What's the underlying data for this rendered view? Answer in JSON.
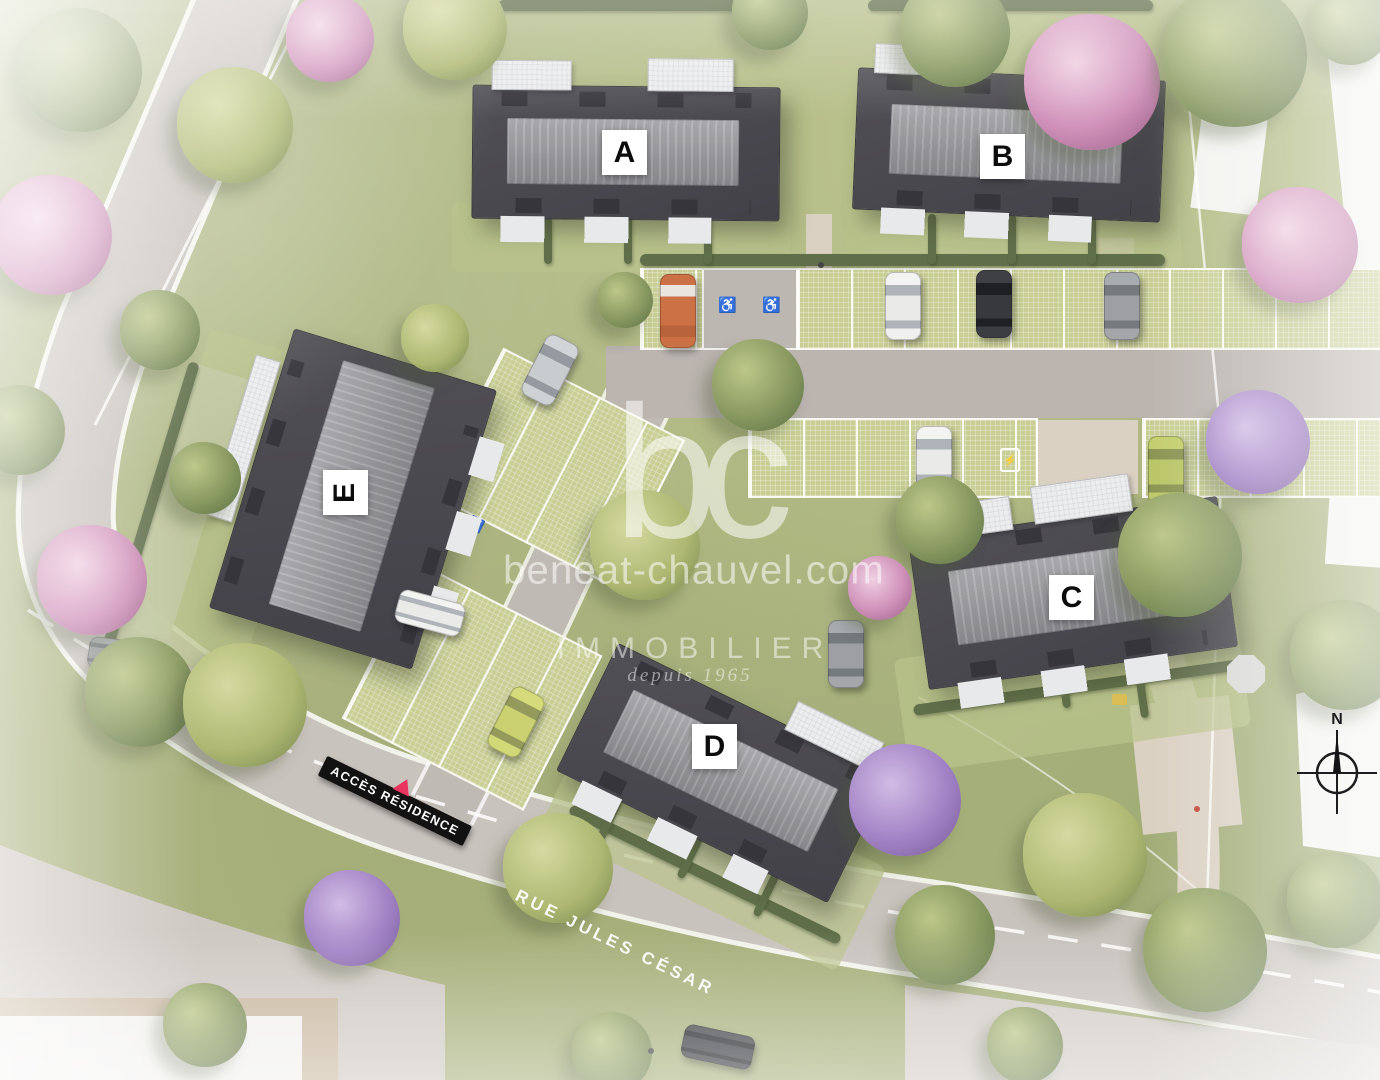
{
  "watermark": {
    "logo_text": "bc",
    "website": "beneat-chauvel.com",
    "brand": "IMMOBILIER",
    "tagline": "depuis 1965"
  },
  "buildings": {
    "a": "A",
    "b": "B",
    "c": "C",
    "d": "D",
    "e": "E"
  },
  "signs": {
    "residence_access": "ACCÈS RÉSIDENCE",
    "street": "RUE JULES CÉSAR"
  },
  "compass": {
    "north_label": "N"
  },
  "icons": {
    "accessible_parking": "♿",
    "ev_charging": "⚡"
  },
  "colors": {
    "grass": "#a7b077",
    "road": "#c6c0ba",
    "driveway": "#b7b0ab",
    "parking_paver": "#c5cb8e",
    "roof_dark": "#3b3a41",
    "roof_ridge": "#909095",
    "hedge": "#57673f",
    "path_beige": "#d9cfc0",
    "sign_background": "#121212",
    "sign_triangle": "#e8355f",
    "watermark_text": "#ffffff"
  }
}
